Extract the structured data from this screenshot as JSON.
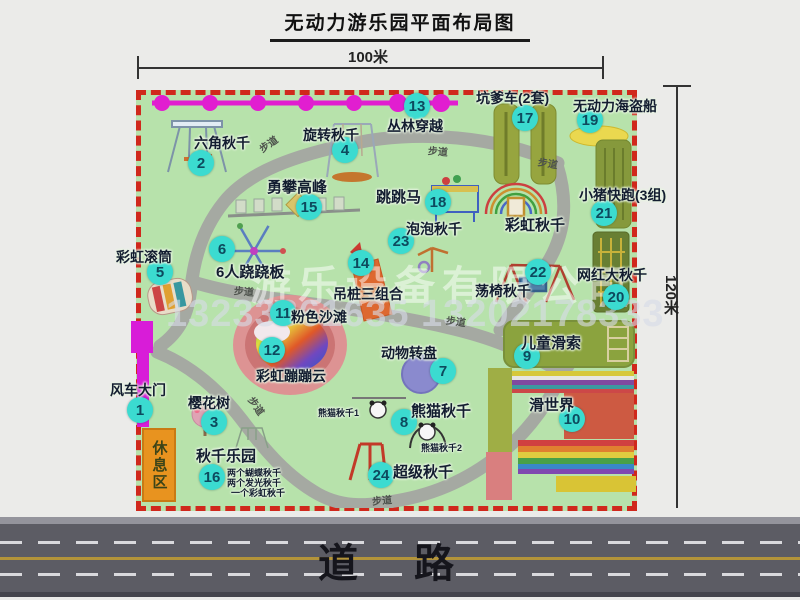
{
  "title": "无动力游乐园平面布局图",
  "dimensions": {
    "width_label": "100米",
    "height_label": "120米"
  },
  "road": {
    "label": "道路"
  },
  "watermark": {
    "company": "游乐设备有限公司",
    "phone": "13233861635 13202178333"
  },
  "rest_area": {
    "label": "休息区"
  },
  "attractions": [
    {
      "num": "1",
      "name": "风车大门",
      "marker": [
        140,
        410
      ],
      "label": [
        110,
        380
      ],
      "size": 14
    },
    {
      "num": "2",
      "name": "六角秋千",
      "marker": [
        201,
        163
      ],
      "label": [
        194,
        133
      ],
      "size": 14
    },
    {
      "num": "3",
      "name": "樱花树",
      "marker": [
        214,
        422
      ],
      "label": [
        188,
        393
      ],
      "size": 14
    },
    {
      "num": "4",
      "name": "旋转秋千",
      "marker": [
        345,
        150
      ],
      "label": [
        303,
        125
      ],
      "size": 14
    },
    {
      "num": "5",
      "name": "彩虹滚筒",
      "marker": [
        160,
        272
      ],
      "label": [
        116,
        247
      ],
      "size": 14
    },
    {
      "num": "6",
      "name": "6人跷跷板",
      "marker": [
        222,
        249
      ],
      "label": [
        216,
        261
      ],
      "size": 15
    },
    {
      "num": "7",
      "name": "动物转盘",
      "marker": [
        443,
        371
      ],
      "label": [
        381,
        343
      ],
      "size": 14
    },
    {
      "num": "8",
      "name": "熊猫秋千",
      "marker": [
        404,
        422
      ],
      "label": [
        411,
        400
      ],
      "size": 15
    },
    {
      "num": "9",
      "name": "儿童滑索",
      "marker": [
        527,
        356
      ],
      "label": [
        521,
        332
      ],
      "size": 15
    },
    {
      "num": "10",
      "name": "滑世界",
      "marker": [
        572,
        419
      ],
      "label": [
        529,
        394
      ],
      "size": 15
    },
    {
      "num": "11",
      "name": "粉色沙滩",
      "marker": [
        283,
        313
      ],
      "label": [
        291,
        307
      ],
      "size": 14
    },
    {
      "num": "12",
      "name": "彩虹蹦蹦云",
      "marker": [
        272,
        350
      ],
      "label": [
        256,
        366
      ],
      "size": 14
    },
    {
      "num": "13",
      "name": "丛林穿越",
      "marker": [
        417,
        106
      ],
      "label": [
        387,
        116
      ],
      "size": 14
    },
    {
      "num": "14",
      "name": "吊桩三组合",
      "marker": [
        361,
        263
      ],
      "label": [
        333,
        284
      ],
      "size": 14
    },
    {
      "num": "15",
      "name": "勇攀高峰",
      "marker": [
        309,
        207
      ],
      "label": [
        267,
        176
      ],
      "size": 15
    },
    {
      "num": "16",
      "name": "秋千乐园",
      "marker": [
        212,
        477
      ],
      "label": [
        196,
        445
      ],
      "size": 15
    },
    {
      "num": "17",
      "name": "坑爹车(2套)",
      "marker": [
        525,
        118
      ],
      "label": [
        476,
        88
      ],
      "size": 14
    },
    {
      "num": "18",
      "name": "跳跳马",
      "marker": [
        438,
        202
      ],
      "label": [
        376,
        186
      ],
      "size": 15
    },
    {
      "num": "19",
      "name": "无动力海盗船",
      "marker": [
        590,
        120
      ],
      "label": [
        573,
        96
      ],
      "size": 14
    },
    {
      "num": "20",
      "name": "网红大秋千",
      "marker": [
        616,
        297
      ],
      "label": [
        577,
        265
      ],
      "size": 14
    },
    {
      "num": "21",
      "name": "小猪快跑(3组)",
      "marker": [
        604,
        213
      ],
      "label": [
        579,
        185
      ],
      "size": 14
    },
    {
      "num": "22",
      "name": "荡椅秋千",
      "marker": [
        538,
        272
      ],
      "label": [
        475,
        281
      ],
      "size": 14
    },
    {
      "num": "23",
      "name": "泡泡秋千",
      "marker": [
        401,
        241
      ],
      "label": [
        406,
        219
      ],
      "size": 14
    },
    {
      "num": "24",
      "name": "超级秋千",
      "marker": [
        381,
        475
      ],
      "label": [
        393,
        461
      ],
      "size": 15
    }
  ],
  "path_labels": [
    {
      "text": "步道",
      "x": 258,
      "y": 136,
      "rot": -35
    },
    {
      "text": "步道",
      "x": 428,
      "y": 143,
      "rot": 5
    },
    {
      "text": "步道",
      "x": 538,
      "y": 155,
      "rot": 10
    },
    {
      "text": "步道",
      "x": 234,
      "y": 283,
      "rot": 5
    },
    {
      "text": "步道",
      "x": 446,
      "y": 313,
      "rot": 8
    },
    {
      "text": "步道",
      "x": 247,
      "y": 398,
      "rot": 55
    },
    {
      "text": "步道",
      "x": 372,
      "y": 492,
      "rot": -5
    }
  ],
  "extra_labels": [
    {
      "text": "彩虹秋千",
      "x": 505,
      "y": 214,
      "size": 15
    },
    {
      "text": "熊猫秋千1",
      "x": 318,
      "y": 406,
      "size": 9
    },
    {
      "text": "熊猫秋千2",
      "x": 421,
      "y": 441,
      "size": 9
    },
    {
      "text": "两个蝴蝶秋千",
      "x": 227,
      "y": 466,
      "size": 9
    },
    {
      "text": "两个发光秋千",
      "x": 227,
      "y": 476,
      "size": 9
    },
    {
      "text": "一个彩虹秋千",
      "x": 231,
      "y": 486,
      "size": 9
    }
  ]
}
